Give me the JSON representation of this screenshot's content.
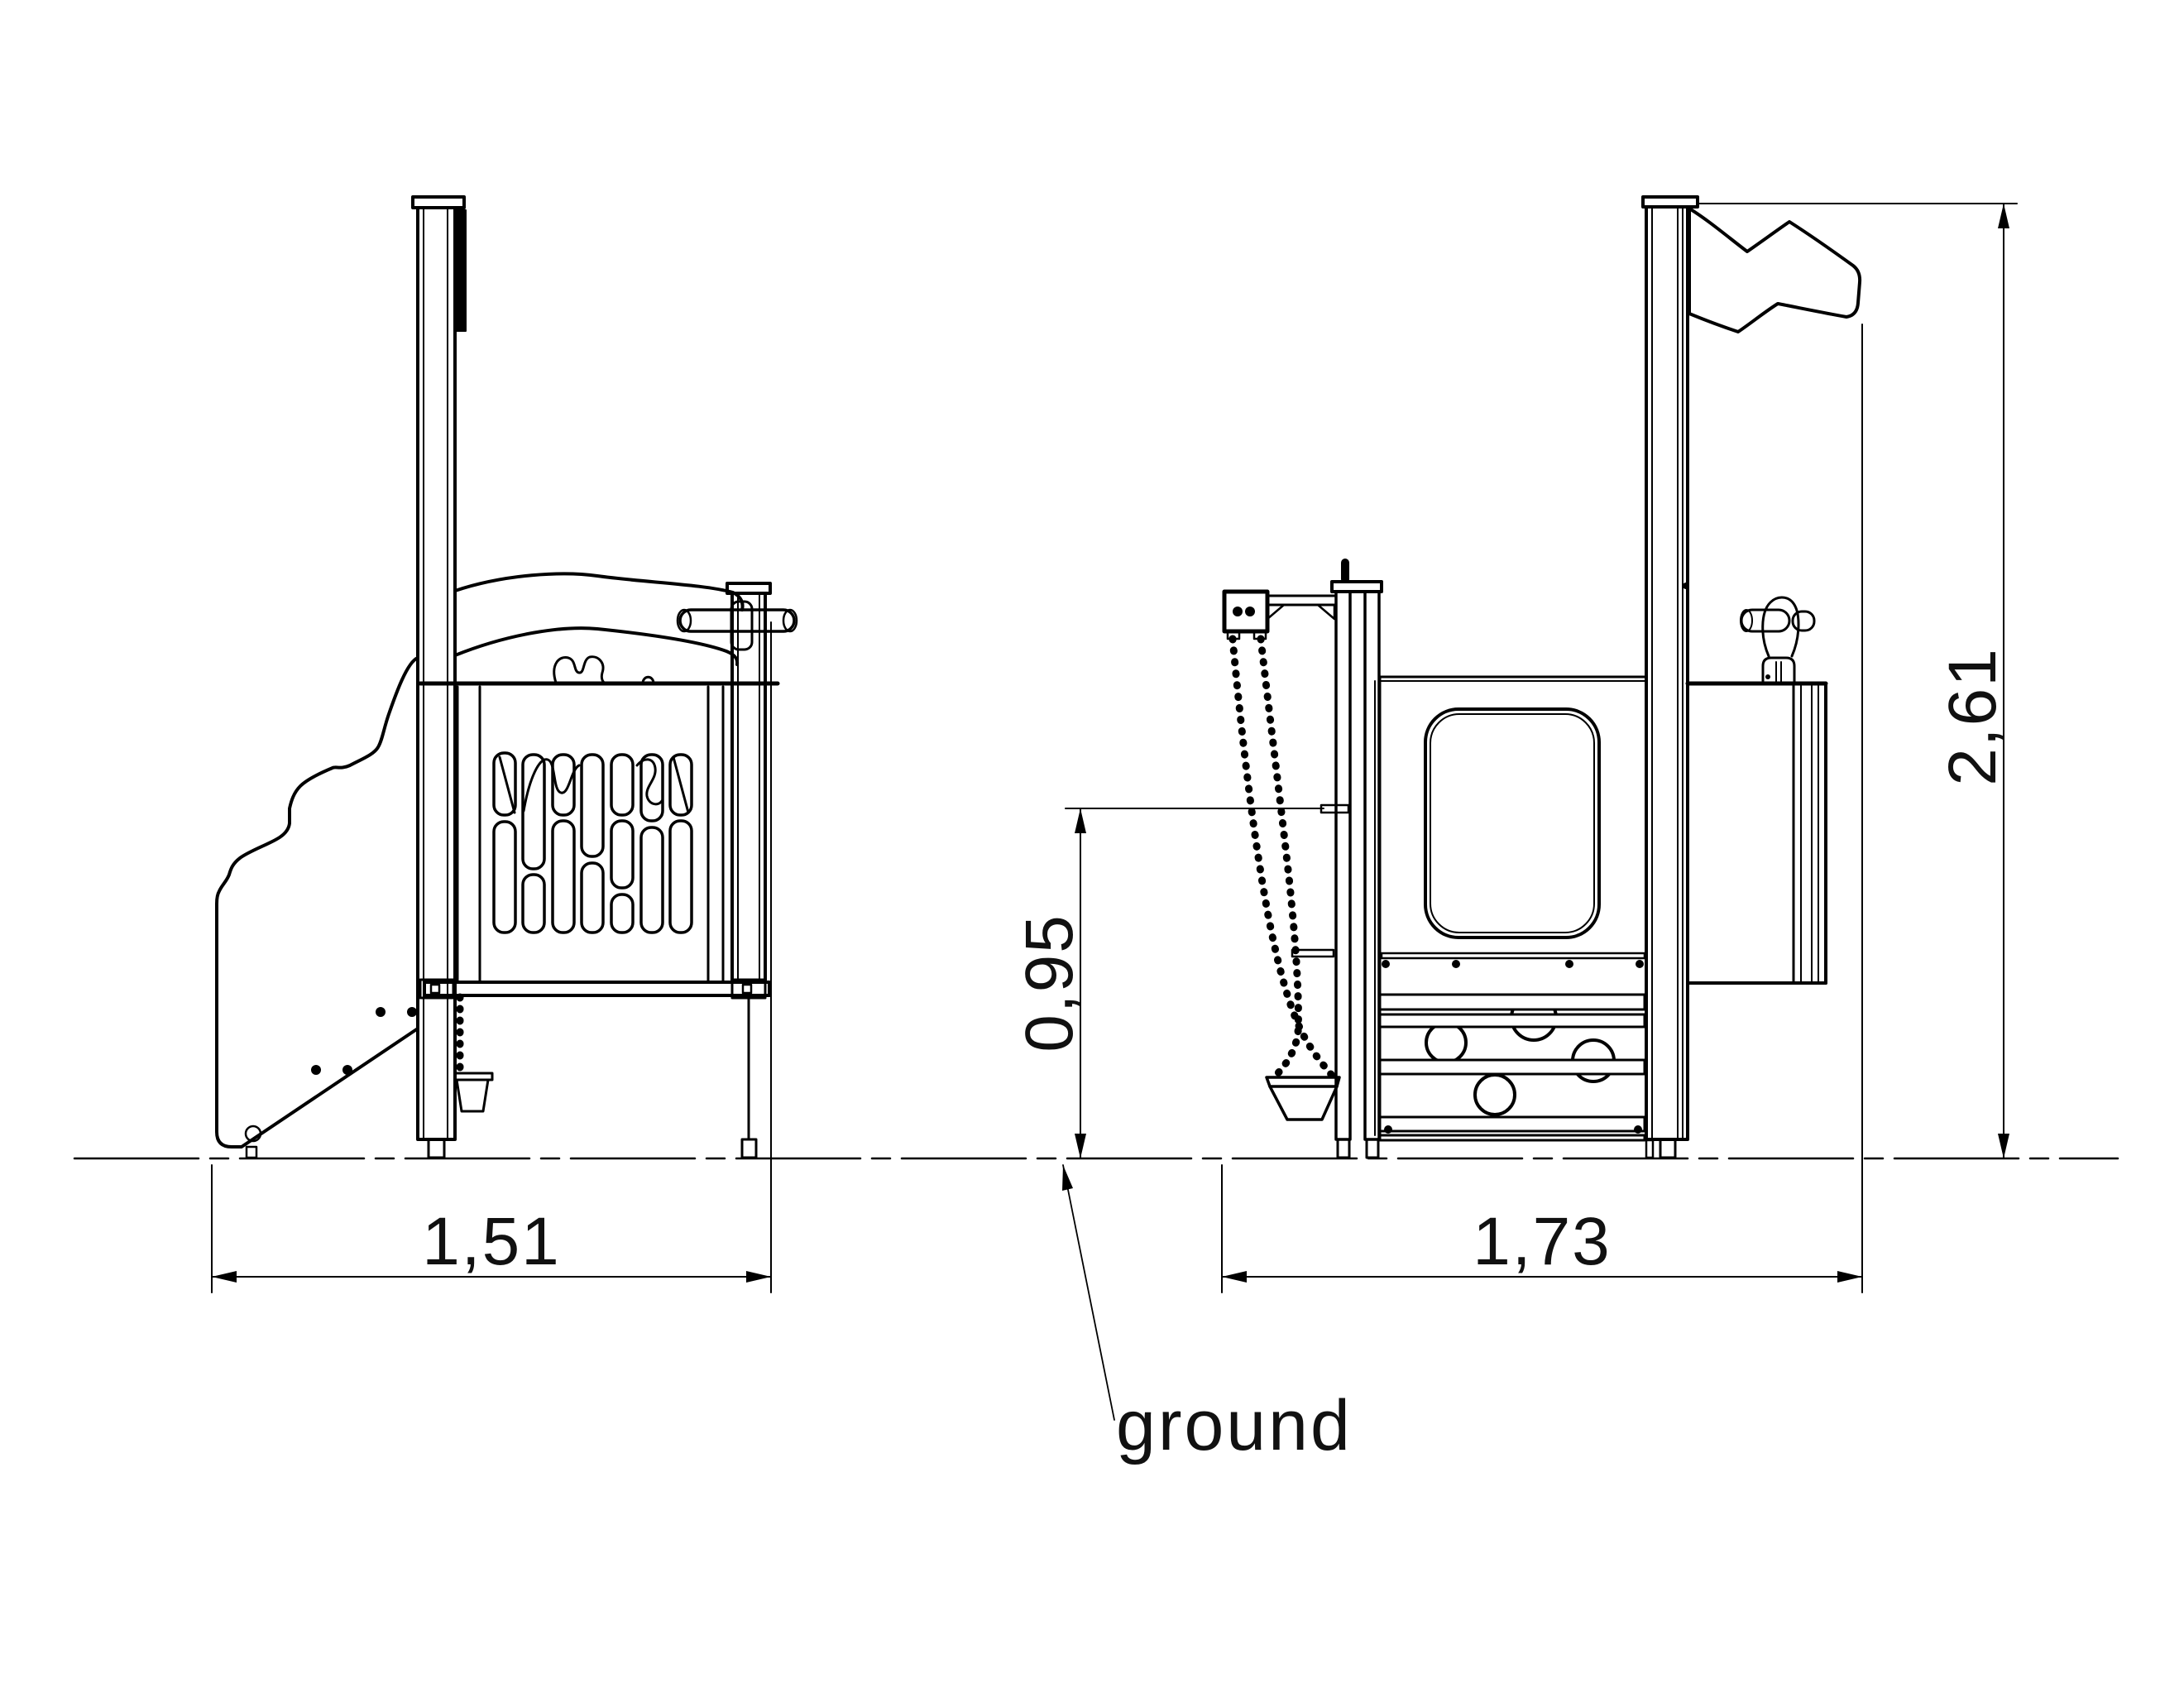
{
  "colors": {
    "line": "#000000",
    "background": "#ffffff"
  },
  "dimensions": {
    "side_view_width": "1,51",
    "front_view_width": "1,73",
    "platform_height": "0,95",
    "overall_height": "2,61"
  },
  "labels": {
    "ground": "ground"
  }
}
